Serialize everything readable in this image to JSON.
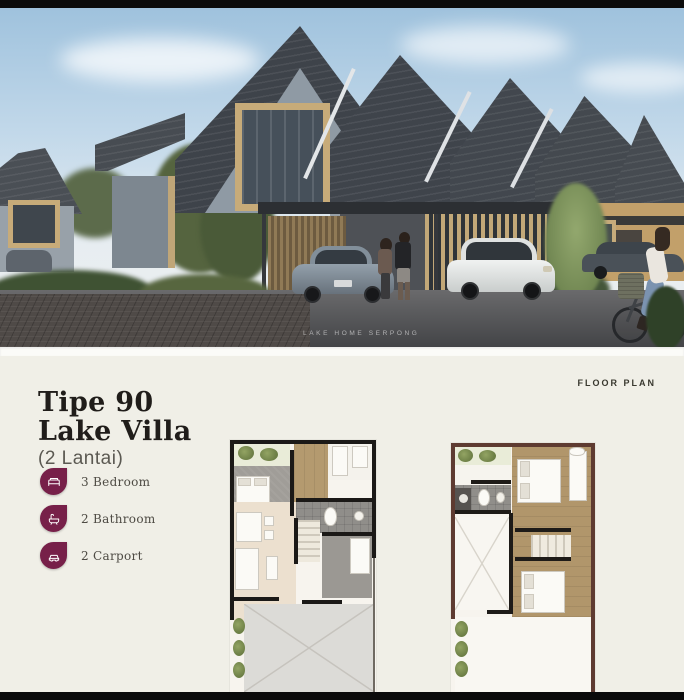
{
  "colors": {
    "background": "#f0efe7",
    "accent": "#772049",
    "bar": "#0b0b0b",
    "title": "#201d1a"
  },
  "hero": {
    "watermark": "LAKE HOME SERPONG"
  },
  "details": {
    "section_label": "FLOOR PLAN",
    "title_line1": "Tipe 90",
    "title_line2": "Lake Villa",
    "subtitle": "(2 Lantai)",
    "features": [
      {
        "icon": "bed-icon",
        "label": "3 Bedroom"
      },
      {
        "icon": "bath-icon",
        "label": "2 Bathroom"
      },
      {
        "icon": "car-icon",
        "label": "2 Carport"
      }
    ]
  }
}
